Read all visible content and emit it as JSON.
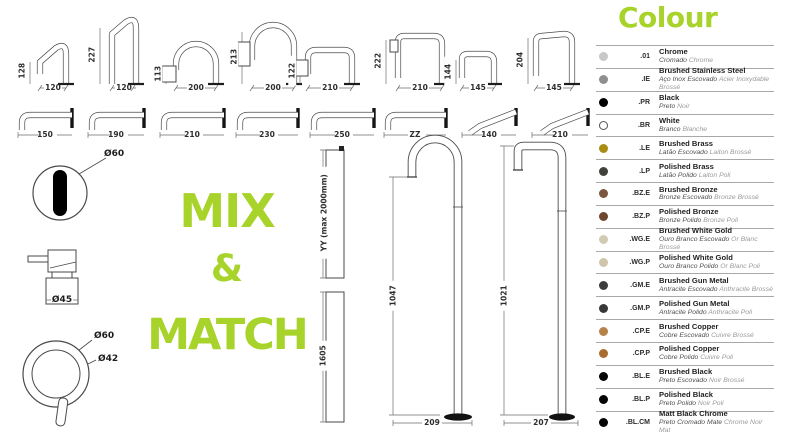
{
  "accent": "#a7d32a",
  "mix_match": {
    "line1": "MIX",
    "line2": "&",
    "line3": "MATCH"
  },
  "goosenecks": [
    {
      "height": "128",
      "width": "120"
    },
    {
      "height": "227",
      "width": "120"
    },
    {
      "height": "113",
      "width": "200"
    },
    {
      "height": "213",
      "width": "200"
    },
    {
      "height": "122",
      "width": "210"
    },
    {
      "height": "222",
      "width": "210"
    },
    {
      "height": "144",
      "width": "145"
    },
    {
      "height": "204",
      "width": "145"
    }
  ],
  "wall_spouts": [
    {
      "length": "150"
    },
    {
      "length": "190"
    },
    {
      "length": "210"
    },
    {
      "length": "230"
    },
    {
      "length": "250"
    },
    {
      "length": "ZZ"
    },
    {
      "length": "140"
    },
    {
      "length": "210"
    }
  ],
  "fixtures": {
    "spout_hole": "Ø60",
    "handle": "Ø45",
    "lever_outer": "Ø60",
    "lever_inner": "Ø42"
  },
  "columns": [
    {
      "label": "YY (max 2000mm)"
    },
    {
      "label": "1605"
    }
  ],
  "floor_spouts": [
    {
      "height": "1047",
      "base": "209"
    },
    {
      "height": "1021",
      "base": "207"
    }
  ],
  "colour": {
    "title": "Colour",
    "rows": [
      {
        "code": ".01",
        "name": "Chrome",
        "sub_pt": "Cromado",
        "sub_fr": "Chrome",
        "dot": "#c8c8c8"
      },
      {
        "code": ".IE",
        "name": "Brushed Stainless Steel",
        "sub_pt": "Aço Inox Escovado",
        "sub_fr": "Acier Inoxydable Brossé",
        "dot": "#8f8f8f"
      },
      {
        "code": ".PR",
        "name": "Black",
        "sub_pt": "Preto",
        "sub_fr": "Noir",
        "dot": "#000000"
      },
      {
        "code": ".BR",
        "name": "White",
        "sub_pt": "Branco",
        "sub_fr": "Blanche",
        "dot": "#ffffff",
        "dot_border": "#555555"
      },
      {
        "code": ".LE",
        "name": "Brushed Brass",
        "sub_pt": "Latão Escovado",
        "sub_fr": "Laiton Brossé",
        "dot": "#a88d12"
      },
      {
        "code": ".LP",
        "name": "Polished Brass",
        "sub_pt": "Latão Polido",
        "sub_fr": "Laiton Poli",
        "dot": "#42423c"
      },
      {
        "code": ".BZ.E",
        "name": "Brushed Bronze",
        "sub_pt": "Bronze Escovado",
        "sub_fr": "Bronze Brossé",
        "dot": "#7c5640"
      },
      {
        "code": ".BZ.P",
        "name": "Polished Bronze",
        "sub_pt": "Bronze Polido",
        "sub_fr": "Bronze Poli",
        "dot": "#6e4730"
      },
      {
        "code": ".WG.E",
        "name": "Brushed White Gold",
        "sub_pt": "Ouro Branco Escovado",
        "sub_fr": "Or Blanc Brossé",
        "dot": "#d3cab4"
      },
      {
        "code": ".WG.P",
        "name": "Polished White Gold",
        "sub_pt": "Ouro Branco Polido",
        "sub_fr": "Or Blanc Poli",
        "dot": "#cec5ab"
      },
      {
        "code": ".GM.E",
        "name": "Brushed Gun Metal",
        "sub_pt": "Antracite Escovado",
        "sub_fr": "Anthracite Brossé",
        "dot": "#3d3d3d"
      },
      {
        "code": ".GM.P",
        "name": "Polished Gun Metal",
        "sub_pt": "Antracite Polido",
        "sub_fr": "Anthracite Poli",
        "dot": "#393939"
      },
      {
        "code": ".CP.E",
        "name": "Brushed Copper",
        "sub_pt": "Cobre Escovado",
        "sub_fr": "Cuivre Brossé",
        "dot": "#b5824a"
      },
      {
        "code": ".CP.P",
        "name": "Polished Copper",
        "sub_pt": "Cobre Polido",
        "sub_fr": "Cuivre Poli",
        "dot": "#a86d2e"
      },
      {
        "code": ".BL.E",
        "name": "Brushed Black",
        "sub_pt": "Preto Escovado",
        "sub_fr": "Noir Brossé",
        "dot": "#050505"
      },
      {
        "code": ".BL.P",
        "name": "Polished Black",
        "sub_pt": "Preto Polido",
        "sub_fr": "Noir Poli",
        "dot": "#050505"
      },
      {
        "code": ".BL.CM",
        "name": "Matt Black Chrome",
        "sub_pt": "Preto Cromado Mate",
        "sub_fr": "Chrome Noir Mat",
        "dot": "#050505"
      }
    ]
  }
}
